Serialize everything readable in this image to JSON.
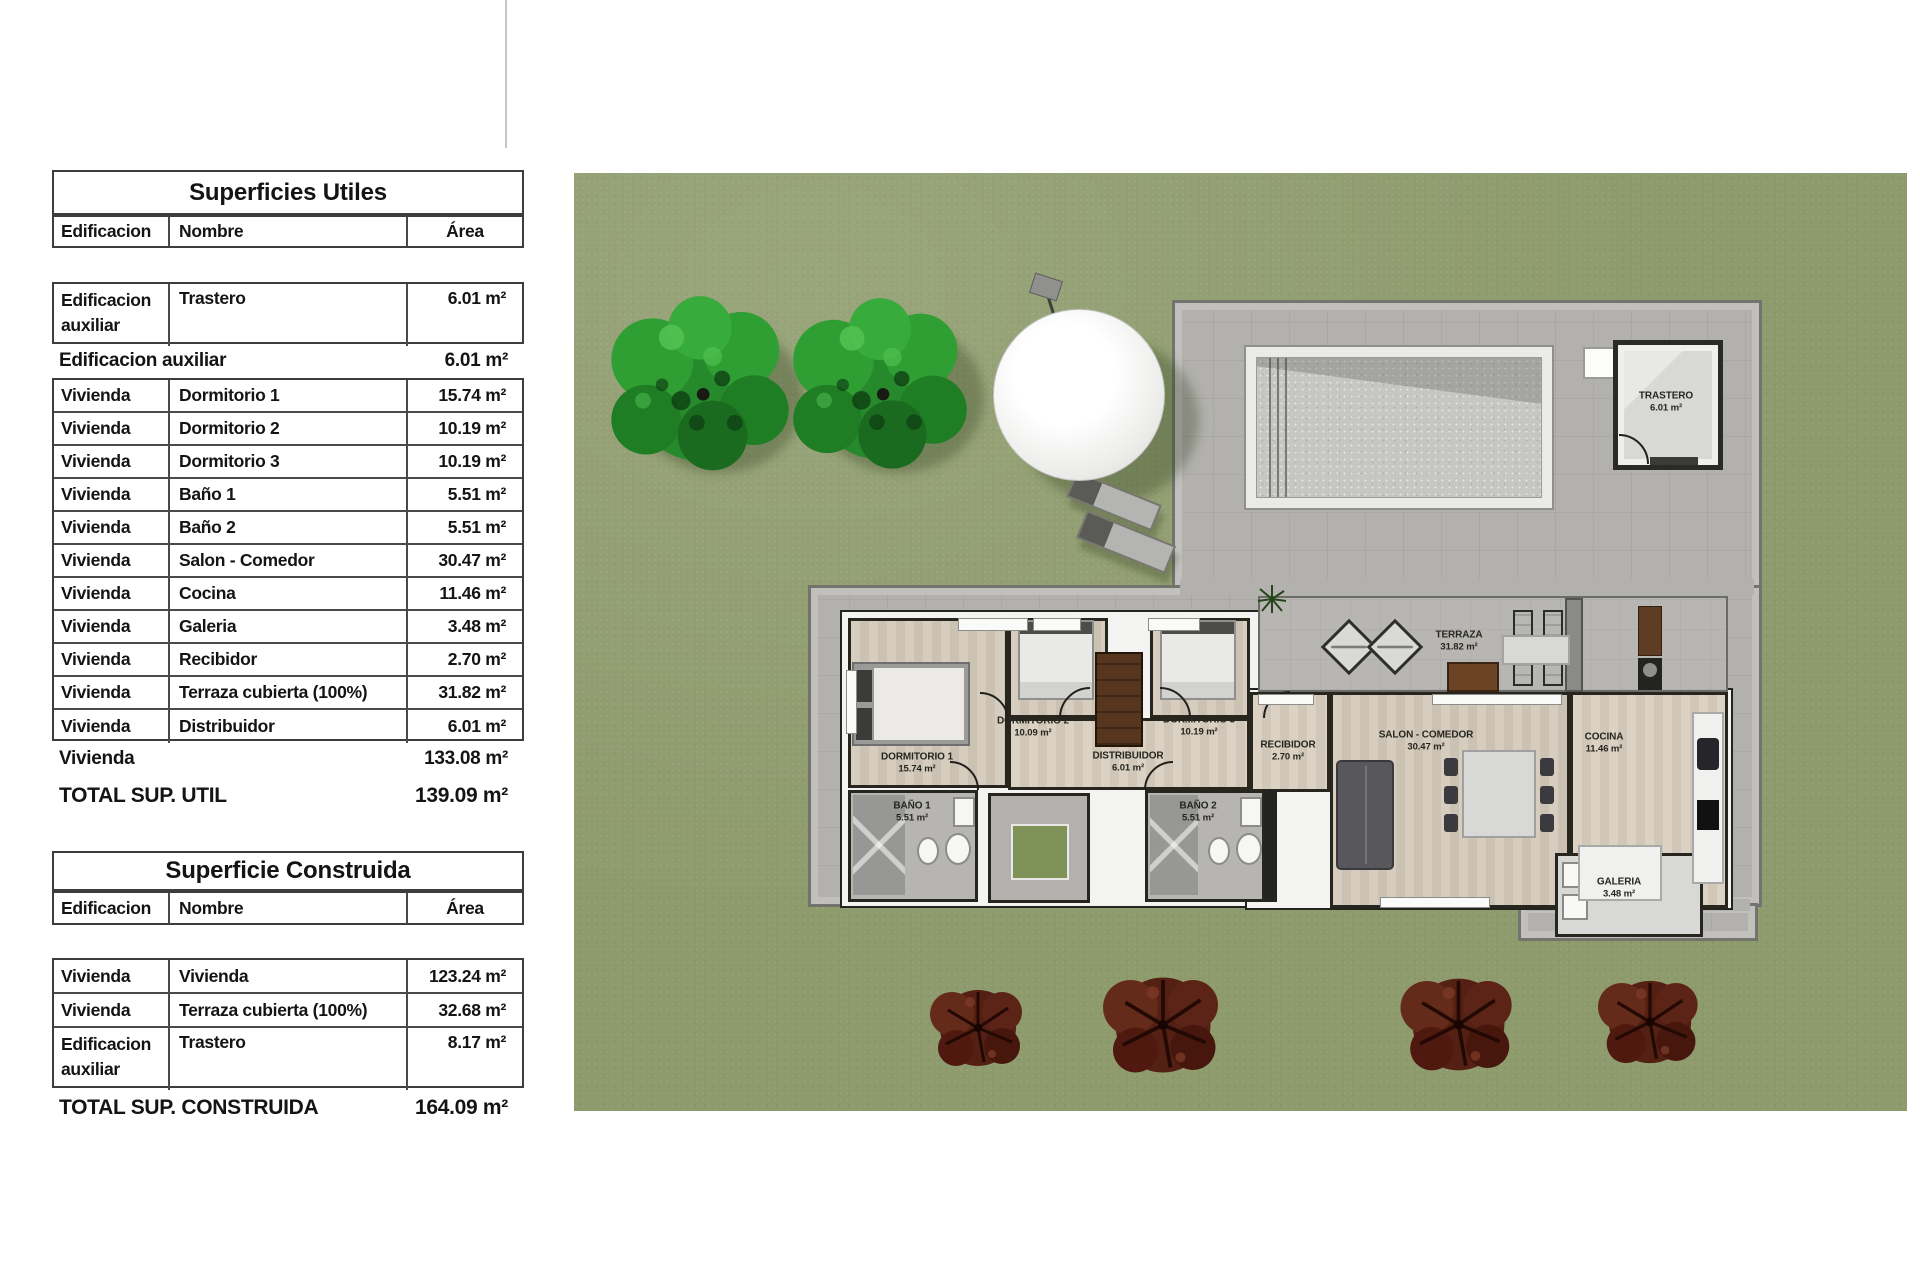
{
  "tables": [
    {
      "id": "superficies-utiles",
      "title": "Superficies Utiles",
      "columns": [
        "Edificacion",
        "Nombre",
        "Área"
      ],
      "sections": [
        {
          "type": "gap"
        },
        {
          "type": "rows",
          "rows": [
            {
              "edificacion": "Edificacion auxiliar",
              "nombre": "Trastero",
              "area": "6.01 m²"
            }
          ]
        },
        {
          "type": "summary",
          "label": "Edificacion auxiliar",
          "value": "6.01 m²"
        },
        {
          "type": "rows",
          "rows": [
            {
              "edificacion": "Vivienda",
              "nombre": "Dormitorio 1",
              "area": "15.74 m²"
            },
            {
              "edificacion": "Vivienda",
              "nombre": "Dormitorio 2",
              "area": "10.19 m²"
            },
            {
              "edificacion": "Vivienda",
              "nombre": "Dormitorio 3",
              "area": "10.19 m²"
            },
            {
              "edificacion": "Vivienda",
              "nombre": "Baño 1",
              "area": "5.51 m²"
            },
            {
              "edificacion": "Vivienda",
              "nombre": "Baño 2",
              "area": "5.51 m²"
            },
            {
              "edificacion": "Vivienda",
              "nombre": "Salon - Comedor",
              "area": "30.47 m²"
            },
            {
              "edificacion": "Vivienda",
              "nombre": "Cocina",
              "area": "11.46 m²"
            },
            {
              "edificacion": "Vivienda",
              "nombre": "Galeria",
              "area": "3.48 m²"
            },
            {
              "edificacion": "Vivienda",
              "nombre": "Recibidor",
              "area": "2.70 m²"
            },
            {
              "edificacion": "Vivienda",
              "nombre": "Terraza cubierta (100%)",
              "area": "31.82 m²"
            },
            {
              "edificacion": "Vivienda",
              "nombre": "Distribuidor",
              "area": "6.01 m²"
            }
          ]
        },
        {
          "type": "summary",
          "label": "Vivienda",
          "value": "133.08 m²"
        },
        {
          "type": "total",
          "label": "TOTAL SUP. UTIL",
          "value": "139.09 m²"
        }
      ]
    },
    {
      "id": "superficie-construida",
      "title": "Superficie Construida",
      "columns": [
        "Edificacion",
        "Nombre",
        "Área"
      ],
      "sections": [
        {
          "type": "gap"
        },
        {
          "type": "rows",
          "rows": [
            {
              "edificacion": "Vivienda",
              "nombre": "Vivienda",
              "area": "123.24 m²"
            },
            {
              "edificacion": "Vivienda",
              "nombre": "Terraza cubierta (100%)",
              "area": "32.68 m²"
            },
            {
              "edificacion": "Edificacion auxiliar",
              "nombre": "Trastero",
              "area": "8.17 m²"
            }
          ]
        },
        {
          "type": "total",
          "label": "TOTAL SUP. CONSTRUIDA",
          "value": "164.09 m²"
        }
      ]
    }
  ],
  "plan": {
    "room_labels": [
      {
        "id": "dormitorio-1",
        "name": "DORMITORIO 1",
        "area": "15.74 m²"
      },
      {
        "id": "dormitorio-2",
        "name": "DORMITORIO 2",
        "area": "10.09 m²"
      },
      {
        "id": "dormitorio-3",
        "name": "DORMITORIO 3",
        "area": "10.19 m²"
      },
      {
        "id": "distribuidor",
        "name": "DISTRIBUIDOR",
        "area": "6.01 m²"
      },
      {
        "id": "bano-1",
        "name": "BAÑO 1",
        "area": "5.51 m²"
      },
      {
        "id": "bano-2",
        "name": "BAÑO 2",
        "area": "5.51 m²"
      },
      {
        "id": "recibidor",
        "name": "RECIBIDOR",
        "area": "2.70 m²"
      },
      {
        "id": "salon-comedor",
        "name": "SALON - COMEDOR",
        "area": "30.47 m²"
      },
      {
        "id": "cocina",
        "name": "COCINA",
        "area": "11.46 m²"
      },
      {
        "id": "terraza",
        "name": "TERRAZA",
        "area": "31.82 m²"
      },
      {
        "id": "galeria",
        "name": "GALERIA",
        "area": "3.48 m²"
      },
      {
        "id": "trastero",
        "name": "TRASTERO",
        "area": "6.01 m²"
      }
    ],
    "colors": {
      "lawn": "#8e9b6c",
      "deck": "#b2b1ad",
      "deck_border": "#74746f",
      "pool_frame": "#eaeae8",
      "pool_water": "#c6c6c4",
      "wall_line": "#26261f",
      "wall_fill": "#f3f3f1",
      "wood_floor": "#d1c8ba",
      "tile_floor": "#b6b5b2",
      "tree_green": "#2f9e33",
      "tree_red": "#552014"
    }
  }
}
